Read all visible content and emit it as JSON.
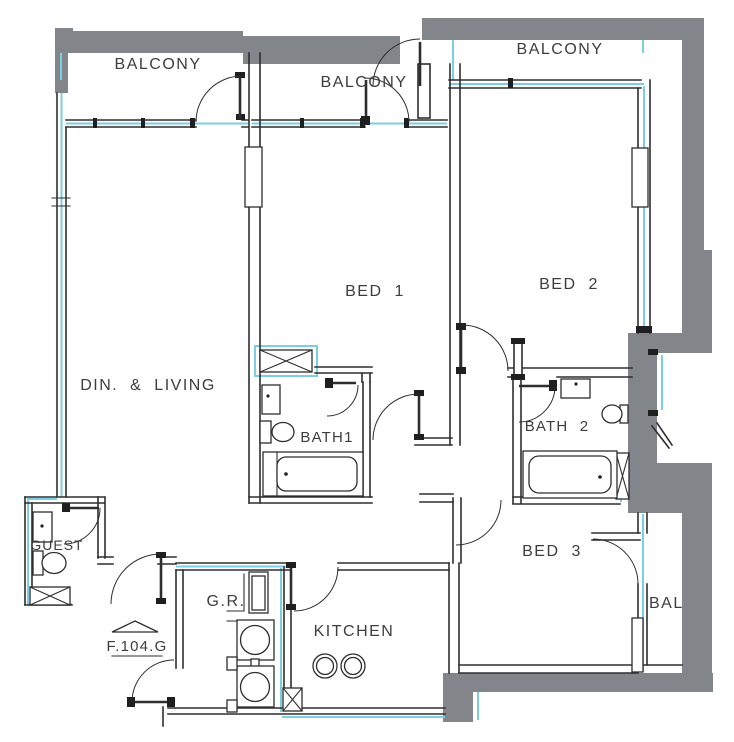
{
  "title": "Apartment unit floor plan",
  "unit": {
    "number": "F.104.G"
  },
  "labels": {
    "balcony_left": "BALCONY",
    "balcony_middle": "BALCONY",
    "balcony_right": "BALCONY",
    "balcony_side_partial": "BAL",
    "bed1": "BED 1",
    "bed2": "BED 2",
    "bed3": "BED 3",
    "dining_living": "DIN. & LIVING",
    "bath1": "BATH1",
    "bath2": "BATH 2",
    "guest": "GUEST",
    "gr": "G.R.",
    "kitchen": "KITCHEN",
    "unit_number": "F.104.G"
  },
  "colors": {
    "wall_gray": "#82858A",
    "glazing_cyan": "#7BCFE2",
    "line_black": "#2E2E2E",
    "text_gray": "#3D3D3D",
    "background": "#FFFFFF"
  }
}
